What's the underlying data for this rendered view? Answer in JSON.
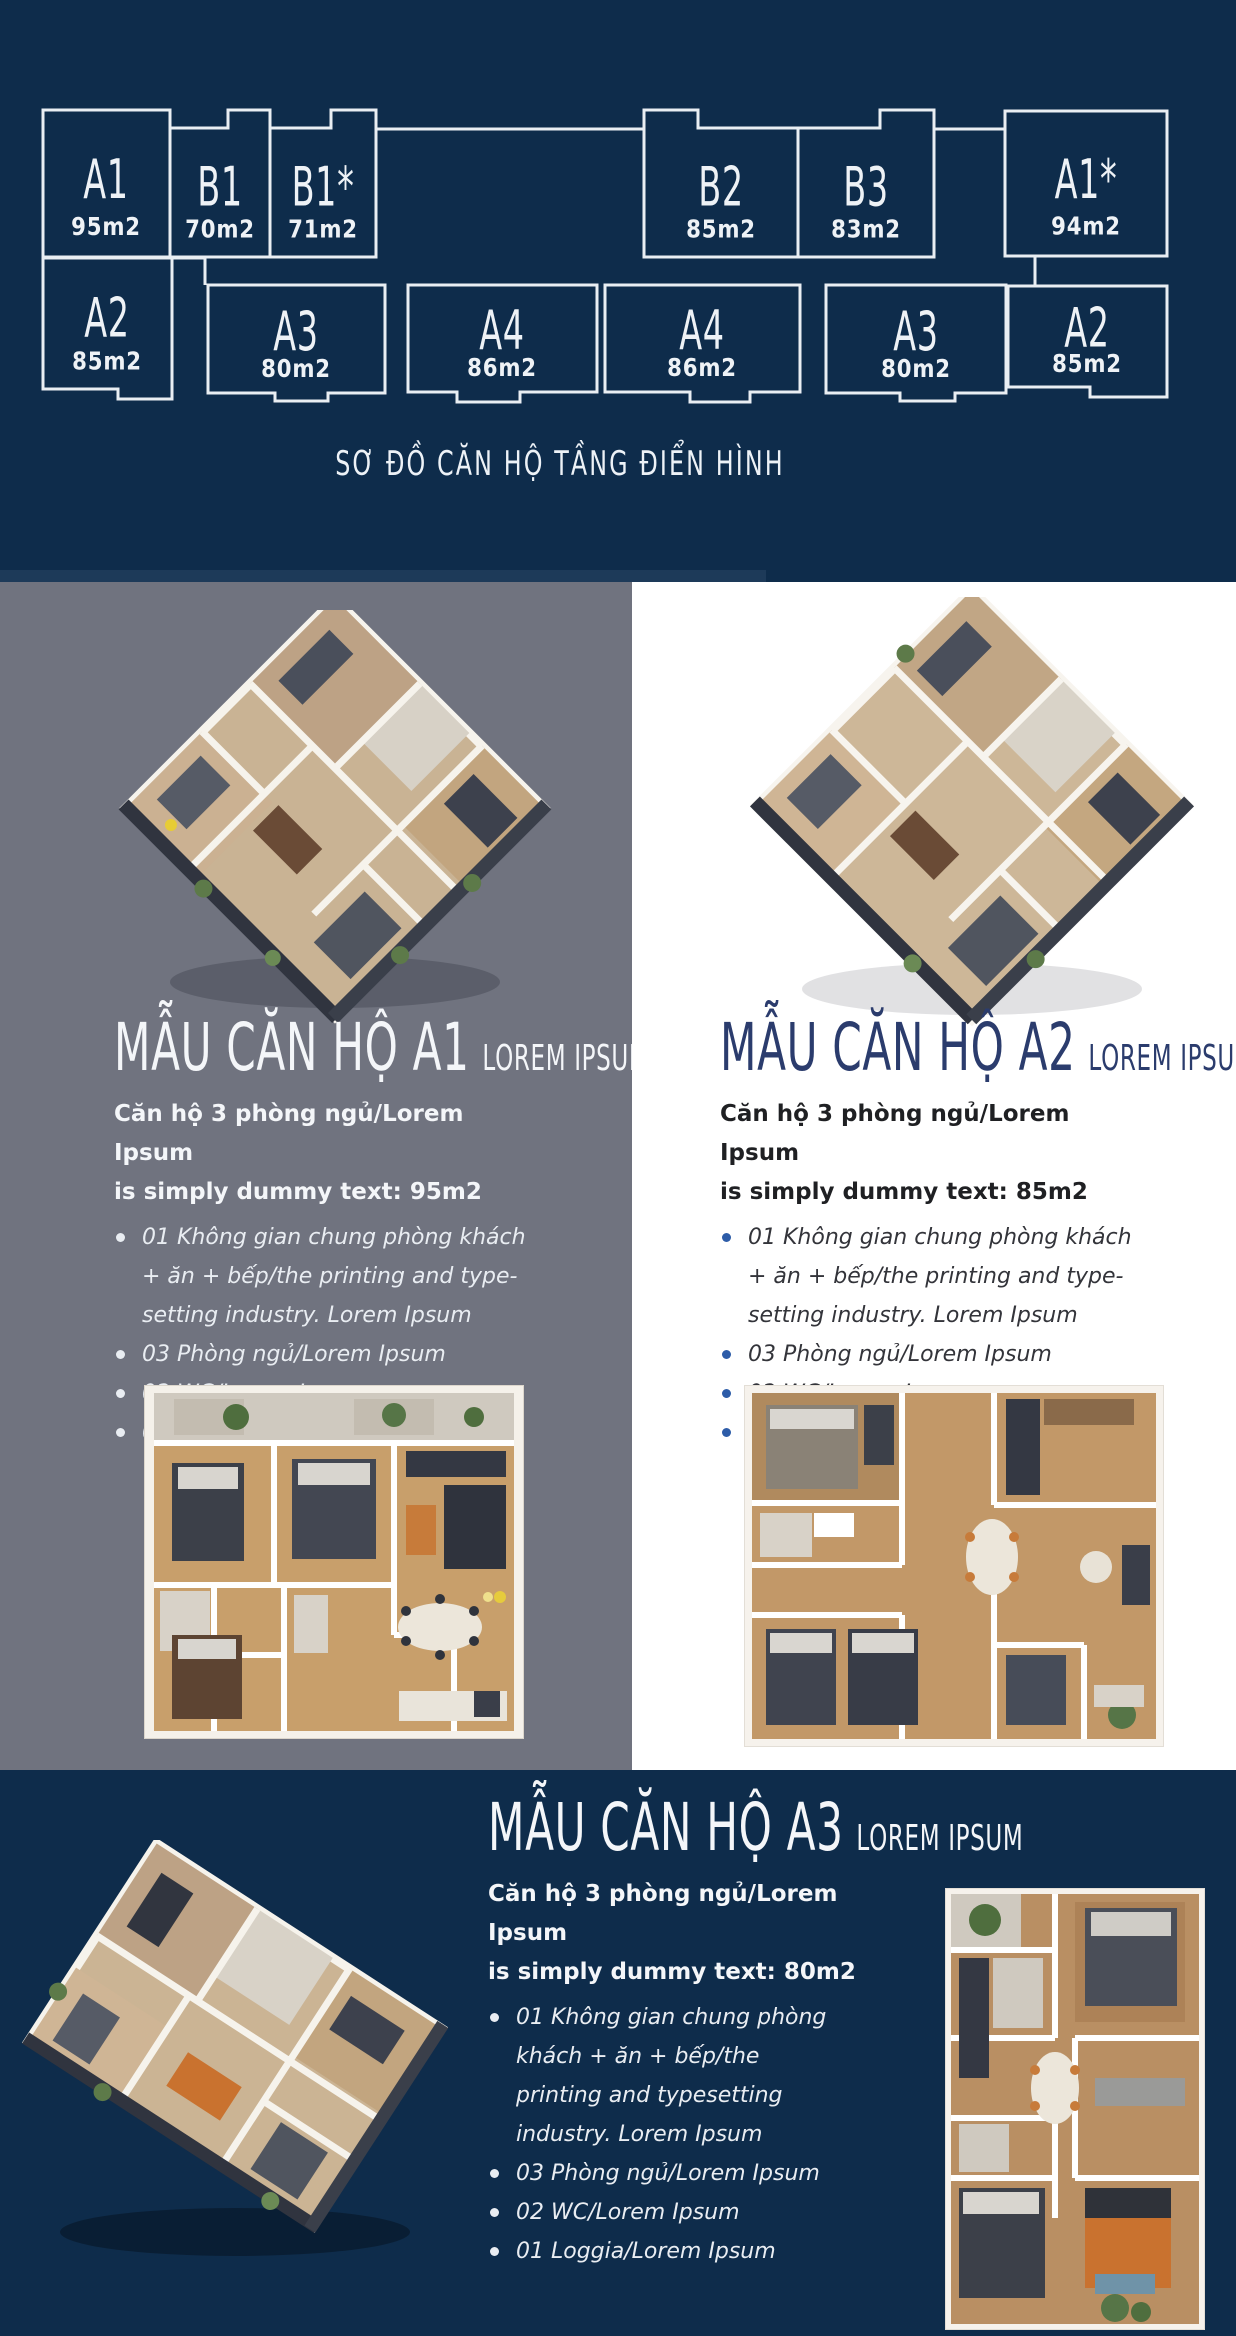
{
  "colors": {
    "navy_bg": "#0e2c4b",
    "gray_panel": "#70737f",
    "white_panel": "#ffffff",
    "diagram_line": "#e9eef3",
    "heading_light": "#f4f6f9",
    "heading_navy": "#2b3c6d",
    "bullet_blue": "#2d5ca8"
  },
  "header": {
    "caption": "SƠ ĐỒ CĂN HỘ TẦNG ĐIỂN HÌNH",
    "units": [
      {
        "code": "A1",
        "area": "95m2"
      },
      {
        "code": "B1",
        "area": "70m2"
      },
      {
        "code": "B1*",
        "area": "71m2"
      },
      {
        "code": "B2",
        "area": "85m2"
      },
      {
        "code": "B3",
        "area": "83m2"
      },
      {
        "code": "A1*",
        "area": "94m2"
      },
      {
        "code": "A2",
        "area": "85m2"
      },
      {
        "code": "A3",
        "area": "80m2"
      },
      {
        "code": "A4",
        "area": "86m2"
      },
      {
        "code": "A4",
        "area": "86m2"
      },
      {
        "code": "A3",
        "area": "80m2"
      },
      {
        "code": "A2",
        "area": "85m2"
      }
    ]
  },
  "sections": {
    "a1": {
      "title": "MẪU CĂN HỘ A1",
      "title_sub": "LOREM IPSUM",
      "desc1": "Căn hộ 3 phòng ngủ/Lorem Ipsum",
      "desc2": "is simply dummy text: 95m2",
      "bullets": [
        "01 Không gian chung phòng khách + ăn + bếp/the printing and type-setting industry. Lorem Ipsum",
        "03 Phòng ngủ/Lorem Ipsum",
        "02 WC/Lorem Ipsum",
        "01 Loggia/Lorem Ipsum"
      ]
    },
    "a2": {
      "title": "MẪU CĂN HỘ A2",
      "title_sub": "LOREM IPSUM",
      "desc1": "Căn hộ 3 phòng ngủ/Lorem Ipsum",
      "desc2": "is simply dummy text: 85m2",
      "bullets": [
        "01 Không gian chung phòng khách + ăn + bếp/the printing and type-setting industry. Lorem Ipsum",
        "03 Phòng ngủ/Lorem Ipsum",
        "02 WC/Lorem Ipsum",
        "01 Loggia/Lorem Ipsum"
      ]
    },
    "a3": {
      "title": "MẪU CĂN HỘ A3",
      "title_sub": "LOREM IPSUM",
      "desc1": "Căn hộ 3 phòng ngủ/Lorem Ipsum",
      "desc2": "is simply dummy text: 80m2",
      "bullets": [
        "01 Không gian chung phòng khách + ăn + bếp/the printing and typesetting industry. Lorem Ipsum",
        "03 Phòng ngủ/Lorem Ipsum",
        "02 WC/Lorem Ipsum",
        "01 Loggia/Lorem Ipsum"
      ]
    }
  }
}
